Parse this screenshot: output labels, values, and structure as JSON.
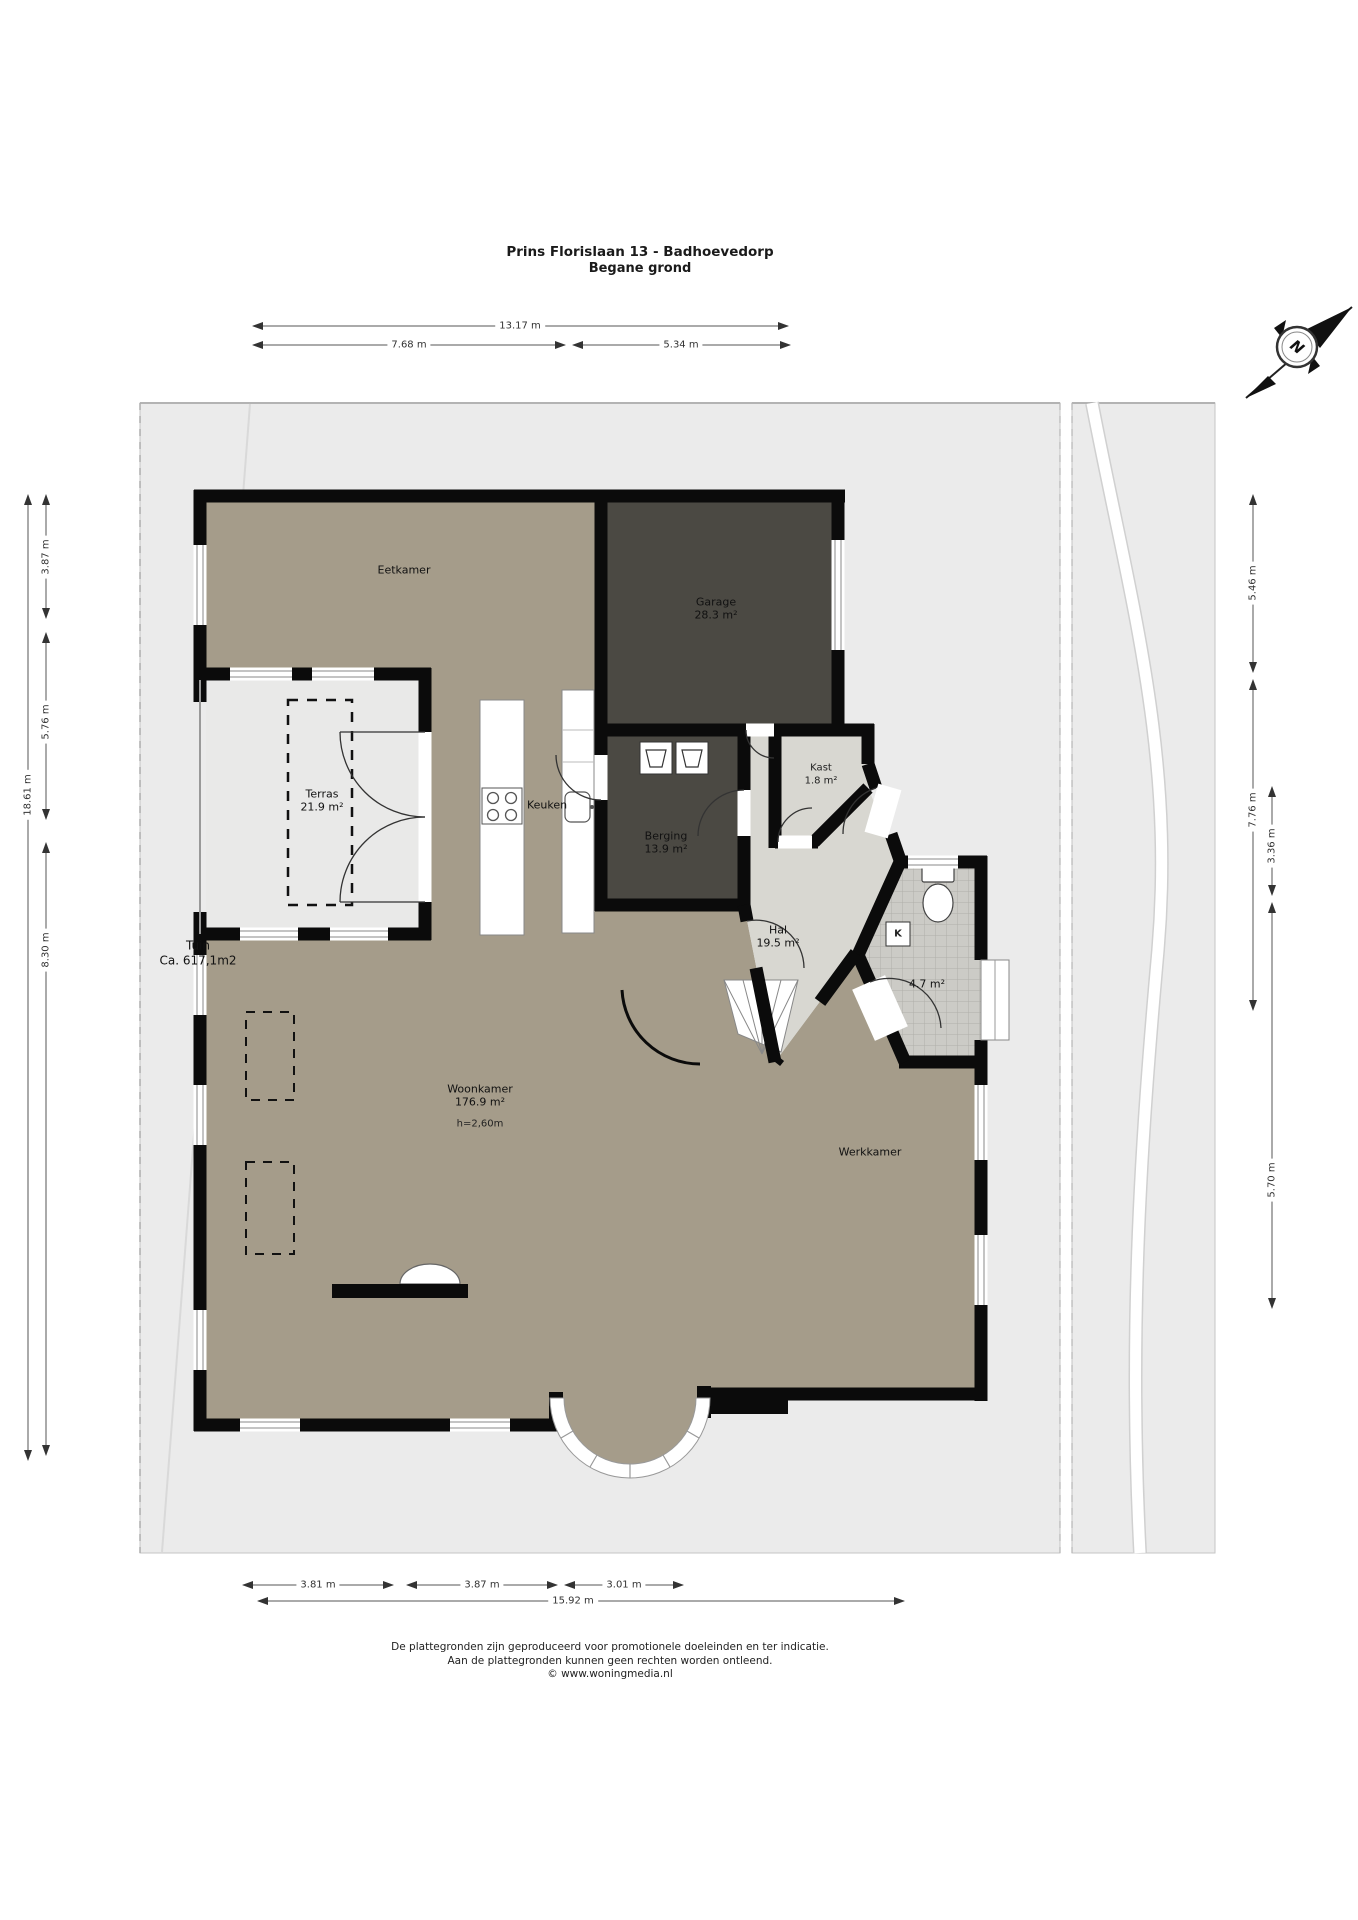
{
  "title": {
    "line1": "Prins Florislaan 13 - Badhoevedorp",
    "line2": "Begane grond"
  },
  "compass": {
    "label": "N"
  },
  "rooms": {
    "eetkamer": {
      "name": "Eetkamer"
    },
    "garage": {
      "name": "Garage",
      "area": "28.3 m²"
    },
    "terras": {
      "name": "Terras",
      "area": "21.9 m²"
    },
    "keuken": {
      "name": "Keuken"
    },
    "berging": {
      "name": "Berging",
      "area": "13.9 m²"
    },
    "kast": {
      "name": "Kast",
      "area": "1.8 m²"
    },
    "hal": {
      "name": "Hal",
      "area": "19.5 m²"
    },
    "badkamer": {
      "area": "4.7 m²"
    },
    "woonkamer": {
      "name": "Woonkamer",
      "area": "176.9 m²",
      "height": "h=2,60m"
    },
    "werkkamer": {
      "name": "Werkkamer"
    },
    "tuin": {
      "name": "Tuin",
      "area": "Ca. 617,1m2"
    },
    "kast_k": {
      "label": "K"
    }
  },
  "dimensions": {
    "top": [
      "13.17 m",
      "7.68 m",
      "5.34 m"
    ],
    "left": [
      "18.61 m",
      "3.87 m",
      "5.76 m",
      "8.30 m"
    ],
    "right": [
      "5.46 m",
      "7.76 m",
      "3.36 m",
      "5.70 m"
    ],
    "bottom": [
      "3.81 m",
      "3.87 m",
      "3.01 m",
      "15.92 m"
    ]
  },
  "footer": {
    "line1": "De plattegronden zijn geproduceerd voor promotionele doeleinden en ter indicatie.",
    "line2": "Aan de plattegronden kunnen geen rechten worden ontleend.",
    "line3": "© www.woningmedia.nl"
  },
  "colors": {
    "floor": "#a59c8a",
    "dark_room": "#4b4943",
    "hall": "#d8d7d1",
    "tile": "#cccbc6",
    "outdoor": "#ebebeb",
    "terras": "#e9e9e8",
    "wall": "#0b0b0b"
  }
}
